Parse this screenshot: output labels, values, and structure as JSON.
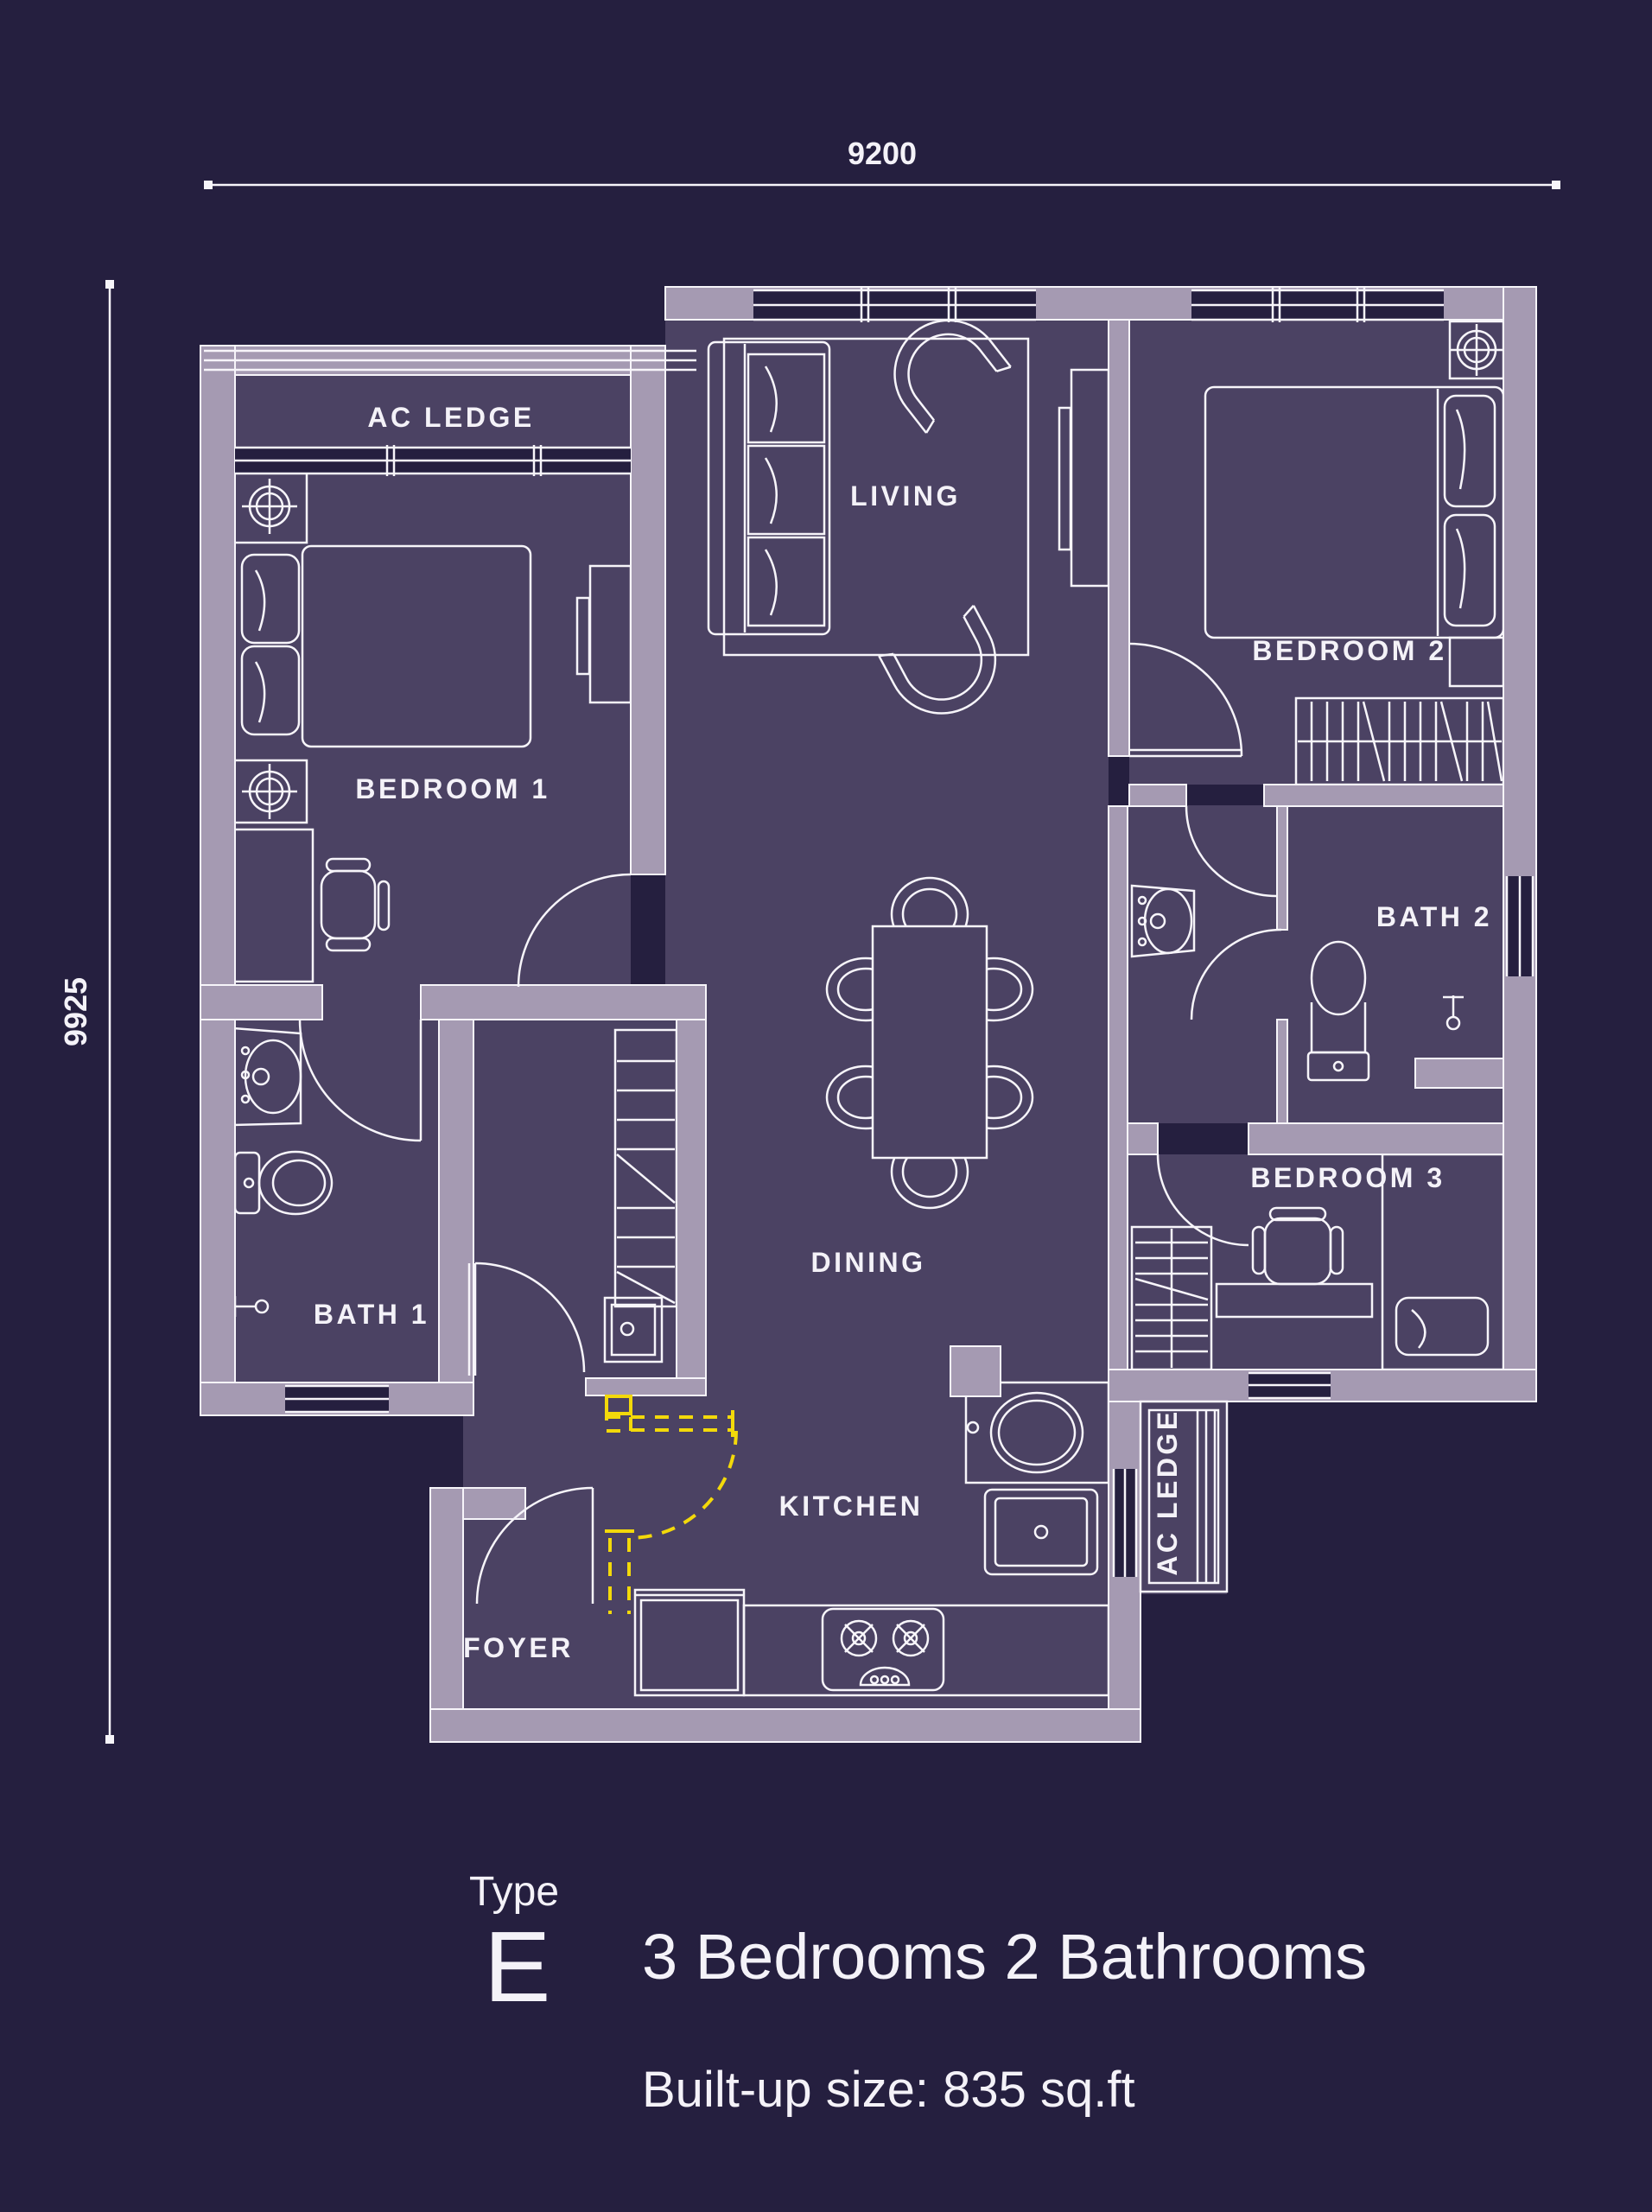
{
  "palette": {
    "background": "#251f3f",
    "room_fill": "#4b4263",
    "wall_fill": "#a59ab2",
    "line": "#f7f5fa",
    "accent_yellow": "#f3d90a",
    "text": "#f4f2f8"
  },
  "dimensions": {
    "top_width": "9200",
    "left_height": "9925"
  },
  "rooms": {
    "ac_ledge_top": {
      "label": "AC LEDGE"
    },
    "bedroom1": {
      "label": "BEDROOM 1"
    },
    "living": {
      "label": "LIVING"
    },
    "bedroom2": {
      "label": "BEDROOM 2"
    },
    "bath1": {
      "label": "BATH 1"
    },
    "bath2": {
      "label": "BATH 2"
    },
    "dining": {
      "label": "DINING"
    },
    "bedroom3": {
      "label": "BEDROOM 3"
    },
    "kitchen": {
      "label": "KITCHEN"
    },
    "foyer": {
      "label": "FOYER"
    },
    "ac_ledge_right": {
      "label": "AC LEDGE"
    }
  },
  "legend": {
    "type_label": "Type",
    "type_value": "E",
    "title": "3 Bedrooms 2 Bathrooms",
    "subtitle": "Built-up size: 835 sq.ft"
  }
}
